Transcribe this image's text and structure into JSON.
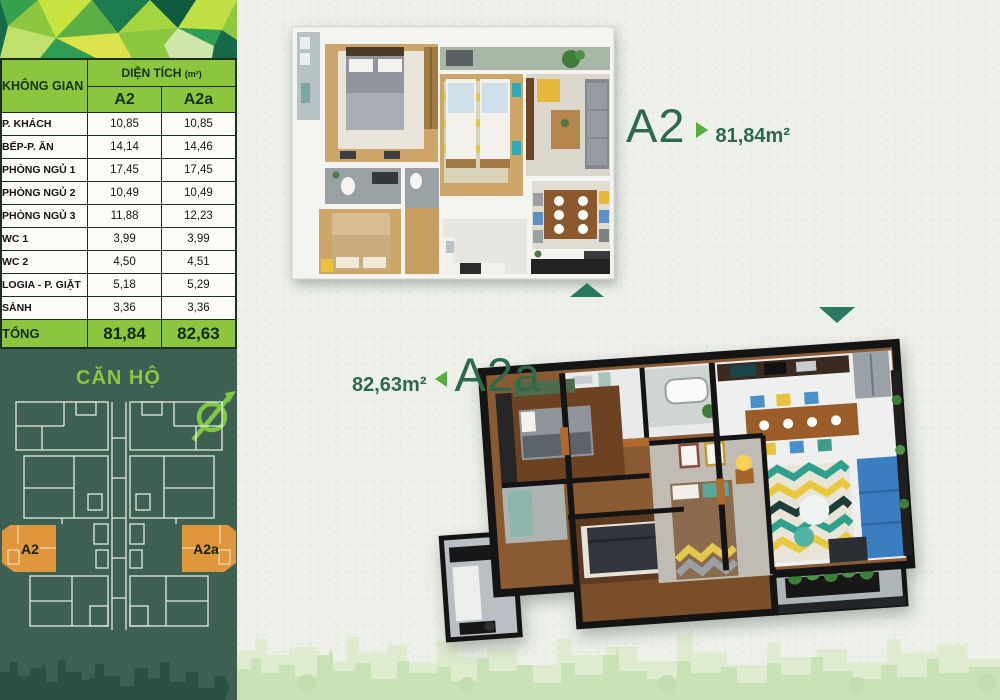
{
  "sidebar": {
    "section_title": "CĂN HỘ",
    "table": {
      "space_header": "KHÔNG GIAN",
      "area_header": "DIỆN TÍCH",
      "area_unit": "(m²)",
      "columns": [
        "A2",
        "A2a"
      ],
      "rows": [
        {
          "label": "P. KHÁCH",
          "a2": "10,85",
          "a2a": "10,85"
        },
        {
          "label": "BẾP-P. ĂN",
          "a2": "14,14",
          "a2a": "14,46"
        },
        {
          "label": "PHÒNG NGỦ 1",
          "a2": "17,45",
          "a2a": "17,45"
        },
        {
          "label": "PHÒNG NGỦ 2",
          "a2": "10,49",
          "a2a": "10,49"
        },
        {
          "label": "PHÒNG NGỦ 3",
          "a2": "11,88",
          "a2a": "12,23"
        },
        {
          "label": "WC 1",
          "a2": "3,99",
          "a2a": "3,99"
        },
        {
          "label": "WC 2",
          "a2": "4,50",
          "a2a": "4,51"
        },
        {
          "label": "LOGIA - P. GIẶT",
          "a2": "5,18",
          "a2a": "5,29"
        },
        {
          "label": "SẢNH",
          "a2": "3,36",
          "a2a": "3,36"
        }
      ],
      "total": {
        "label": "TỔNG",
        "a2": "81,84",
        "a2a": "82,63"
      }
    },
    "highlight_units": [
      {
        "label": "A2"
      },
      {
        "label": "A2a"
      }
    ]
  },
  "plans": {
    "a2": {
      "name": "A2",
      "area": "81,84m²"
    },
    "a2a": {
      "name": "A2a",
      "area": "82,63m²"
    }
  },
  "icons": {
    "compass": "north-compass-icon",
    "a2_marker": "triangle-right-icon",
    "a2a_marker": "triangle-left-icon",
    "plan_top_marker": "triangle-up-icon",
    "plan_bottom_marker": "triangle-down-icon"
  },
  "colors": {
    "accent_green": "#8cc63e",
    "dark_panel_green": "#3d6052",
    "teal_marker": "#2a7a62",
    "unit_orange": "#e0973c",
    "label_green": "#2d6a4b"
  }
}
